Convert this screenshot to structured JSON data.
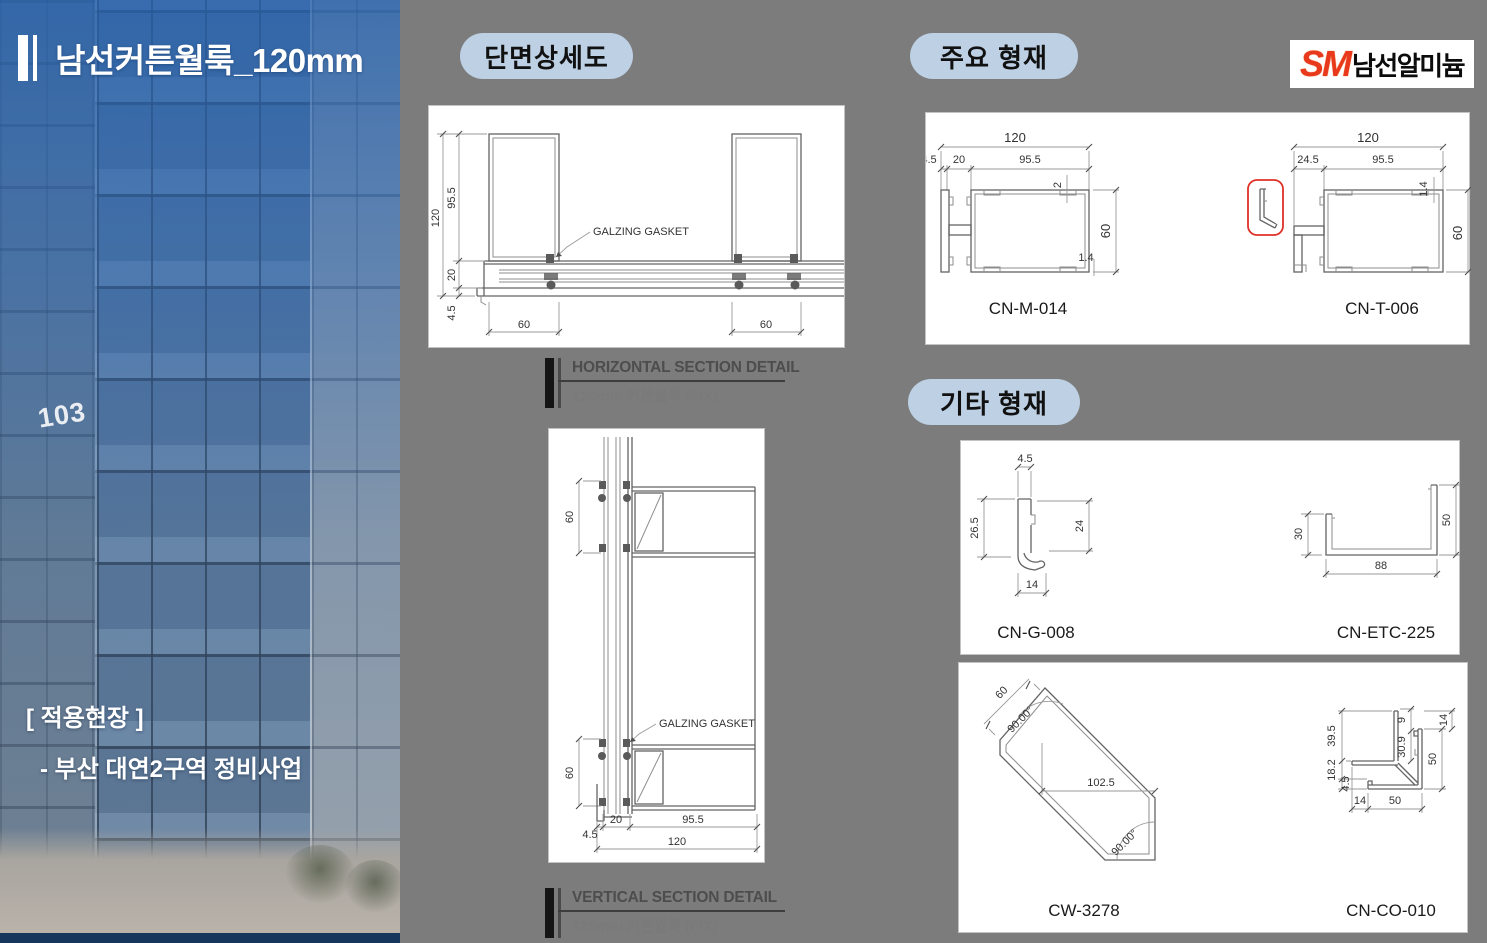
{
  "panel": {
    "title": "남선커튼월룩_120mm",
    "site_label": "[ 적용현장 ]",
    "site_name": "- 부산 대연2구역 정비사업",
    "building_number": "103"
  },
  "badges": {
    "section_detail": "단면상세도",
    "main_profiles": "주요 형재",
    "etc_profiles": "기타 형재"
  },
  "logo": {
    "mark": "SM",
    "company": "남선알미늄"
  },
  "hsection": {
    "d120": "120",
    "d955": "95.5",
    "d20": "20",
    "d45": "4.5",
    "w60a": "60",
    "w60b": "60",
    "gasket": "GALZING GASKET",
    "cap_title": "HORIZONTAL SECTION DETAIL",
    "cap_sub": "120mm 커튼월룩 (FIX)"
  },
  "vsection": {
    "t60a": "60",
    "t60b": "60",
    "d45": "4.5",
    "d20": "20",
    "d955": "95.5",
    "d120": "120",
    "gasket": "GALZING GASKET",
    "cap_title": "VERTICAL SECTION DETAIL",
    "cap_sub": "120mm 커튼월룩 (FIX)"
  },
  "m014": {
    "name": "CN-M-014",
    "d120": "120",
    "d45": "4.5",
    "d20": "20",
    "d955": "95.5",
    "d60": "60",
    "t2": "2",
    "t14": "1.4"
  },
  "t006": {
    "name": "CN-T-006",
    "d120": "120",
    "d245": "24.5",
    "d955": "95.5",
    "d60": "60",
    "t14": "1.4"
  },
  "g008": {
    "name": "CN-G-008",
    "d45": "4.5",
    "d265": "26.5",
    "d24": "24",
    "d14": "14"
  },
  "etc225": {
    "name": "CN-ETC-225",
    "d30": "30",
    "d50": "50",
    "d88": "88"
  },
  "cw3278": {
    "name": "CW-3278",
    "d60": "60",
    "a1": "90.00°",
    "d1025": "102.5",
    "a2": "90.00°"
  },
  "co010": {
    "name": "CN-CO-010",
    "d395": "39.5",
    "d182": "18.2",
    "d45": "4.5",
    "d9": "9",
    "d309": "30.9",
    "d14r": "14",
    "d50r": "50",
    "d14b": "14",
    "d50b": "50"
  }
}
